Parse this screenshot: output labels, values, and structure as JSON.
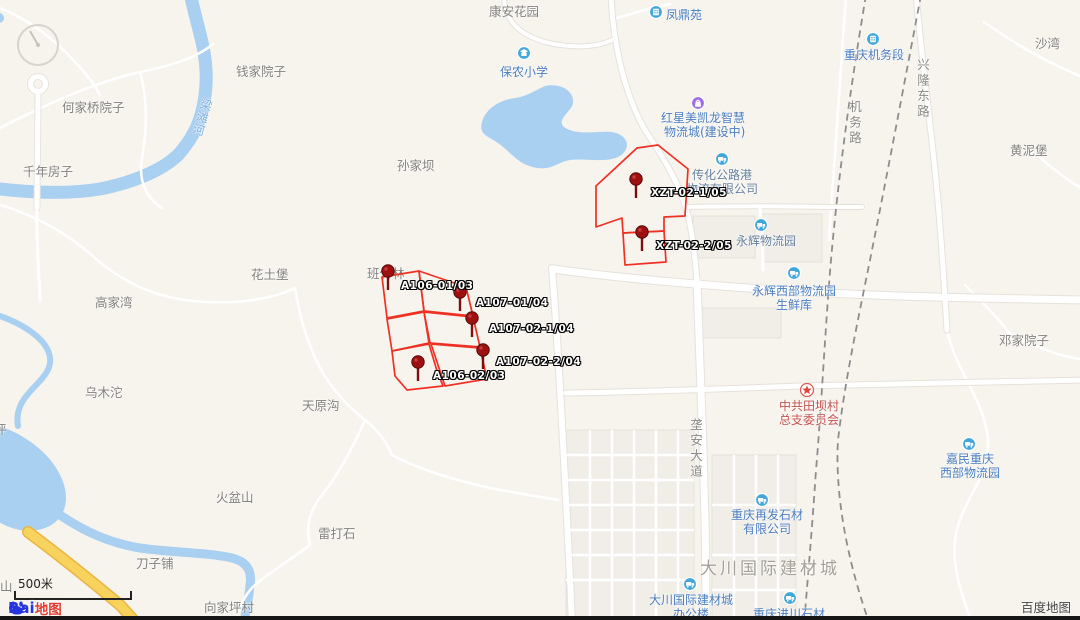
{
  "ui": {
    "scale_label": "500米",
    "attribution": "百度地图",
    "logo": {
      "bai": "Bai",
      "du": "地图"
    }
  },
  "map": {
    "colors": {
      "poi_blue": "#4a7dc0",
      "poi_grayblue": "#64819e",
      "poi_red": "#c4524e",
      "overlay_red": "#ef3124",
      "water": "#a9cff1",
      "icon_teal": "#41a7da",
      "icon_purple": "#a06ee0"
    },
    "town_labels": [
      {
        "t": "何家桥院子",
        "x": 62,
        "y": 97
      },
      {
        "t": "千年房子",
        "x": 23,
        "y": 161
      },
      {
        "t": "钱家院子",
        "x": 236,
        "y": 61
      },
      {
        "t": "孙家坝",
        "x": 397,
        "y": 155
      },
      {
        "t": "康安花园",
        "x": 489,
        "y": 1
      },
      {
        "t": "高家湾",
        "x": 95,
        "y": 292
      },
      {
        "t": "花土堡",
        "x": 251,
        "y": 264
      },
      {
        "t": "班竹林",
        "x": 367,
        "y": 263
      },
      {
        "t": "乌木沱",
        "x": 85,
        "y": 382
      },
      {
        "t": "天原沟",
        "x": 302,
        "y": 395
      },
      {
        "t": "火盆山",
        "x": 216,
        "y": 487
      },
      {
        "t": "雷打石",
        "x": 318,
        "y": 523
      },
      {
        "t": "刀子铺",
        "x": 136,
        "y": 553
      },
      {
        "t": "向家坪村",
        "x": 204,
        "y": 597
      },
      {
        "t": "沙湾",
        "x": 1035,
        "y": 33
      },
      {
        "t": "黄泥堡",
        "x": 1010,
        "y": 140
      },
      {
        "t": "邓家院子",
        "x": 999,
        "y": 330
      }
    ],
    "street_labels": [
      {
        "t": "机务路",
        "x": 845,
        "y": 100
      },
      {
        "t": "兴隆东路",
        "x": 913,
        "y": 58
      },
      {
        "t": "垄安大道",
        "x": 686,
        "y": 418
      }
    ],
    "area_label": {
      "t": "大川国际建材城",
      "x": 700,
      "y": 554
    },
    "river_label": {
      "t": "梁滩河",
      "x": 194,
      "y": 98
    },
    "partial_labels": [
      {
        "t": "坪",
        "x": -6,
        "y": 419
      },
      {
        "t": "山",
        "x": 0,
        "y": 576
      }
    ],
    "pois": [
      {
        "name": "baonong-primary-school",
        "icon": "school",
        "ix": 517,
        "iy": 46,
        "color": "#4a7dc0",
        "lines": [
          {
            "t": "保农小学",
            "x": 500,
            "y": 63
          }
        ]
      },
      {
        "name": "fengdingyuan",
        "icon": "building",
        "ix": 649,
        "iy": 5,
        "color": "#4a7dc0",
        "lines": [
          {
            "t": "凤鼎苑",
            "x": 666,
            "y": 6
          }
        ]
      },
      {
        "name": "hongxing-meikailong",
        "icon": "mall",
        "ix": 691,
        "iy": 96,
        "color": "#4a7dc0",
        "lines": [
          {
            "t": "红星美凯龙智慧",
            "x": 661,
            "y": 109
          },
          {
            "t": "物流城(建设中)",
            "x": 664,
            "y": 123
          }
        ]
      },
      {
        "name": "chuanhua-highway-port",
        "icon": "truck",
        "ix": 715,
        "iy": 152,
        "color": "#64819e",
        "lines": [
          {
            "t": "传化公路港",
            "x": 692,
            "y": 166
          },
          {
            "t": "物流有限公司",
            "x": 686,
            "y": 180
          }
        ]
      },
      {
        "name": "yonghui-logistics-park",
        "icon": "truck",
        "ix": 754,
        "iy": 218,
        "color": "#64819e",
        "lines": [
          {
            "t": "永辉物流园",
            "x": 736,
            "y": 232
          }
        ]
      },
      {
        "name": "yonghui-west-fresh",
        "icon": "truck",
        "ix": 787,
        "iy": 266,
        "color": "#4a7dc0",
        "lines": [
          {
            "t": "永辉西部物流园",
            "x": 752,
            "y": 282
          },
          {
            "t": "生鲜库",
            "x": 776,
            "y": 296
          }
        ]
      },
      {
        "name": "chongqing-locomotive-depot",
        "icon": "building",
        "ix": 866,
        "iy": 32,
        "color": "#4a7dc0",
        "lines": [
          {
            "t": "重庆机务段",
            "x": 844,
            "y": 46
          }
        ]
      },
      {
        "name": "tianba-village-committee",
        "icon": "star",
        "ix": 800,
        "iy": 383,
        "color": "#c4524e",
        "lines": [
          {
            "t": "中共田坝村",
            "x": 779,
            "y": 397
          },
          {
            "t": "总支委员会",
            "x": 779,
            "y": 411
          }
        ]
      },
      {
        "name": "goodman-west-logistics",
        "icon": "truck",
        "ix": 962,
        "iy": 437,
        "color": "#4a7dc0",
        "lines": [
          {
            "t": "嘉民重庆",
            "x": 946,
            "y": 450
          },
          {
            "t": "西部物流园",
            "x": 940,
            "y": 464
          }
        ]
      },
      {
        "name": "zaifa-stone",
        "icon": "truck",
        "ix": 755,
        "iy": 493,
        "color": "#4a7dc0",
        "lines": [
          {
            "t": "重庆再发石材",
            "x": 731,
            "y": 506
          },
          {
            "t": "有限公司",
            "x": 743,
            "y": 520
          }
        ]
      },
      {
        "name": "dachuan-office",
        "icon": "truck",
        "ix": 683,
        "iy": 577,
        "color": "#4a7dc0",
        "lines": [
          {
            "t": "大川国际建材城",
            "x": 649,
            "y": 591
          },
          {
            "t": "办公楼",
            "x": 673,
            "y": 605
          }
        ]
      },
      {
        "name": "jinchuan-stone",
        "icon": "truck",
        "ix": 783,
        "iy": 591,
        "color": "#4a7dc0",
        "lines": [
          {
            "t": "重庆进川石材",
            "x": 753,
            "y": 605
          }
        ]
      }
    ],
    "pins": [
      {
        "label": "A106-01/03",
        "x": 388,
        "y": 271,
        "lx": 401,
        "ly": 280
      },
      {
        "label": "A107-01/04",
        "x": 460,
        "y": 292,
        "lx": 476,
        "ly": 297
      },
      {
        "label": "A107-02-1/04",
        "x": 472,
        "y": 318,
        "lx": 489,
        "ly": 323
      },
      {
        "label": "A107-02-2/04",
        "x": 483,
        "y": 350,
        "lx": 496,
        "ly": 356
      },
      {
        "label": "A106-02/03",
        "x": 418,
        "y": 362,
        "lx": 433,
        "ly": 370
      },
      {
        "label": "XZT-02-1/05",
        "x": 636,
        "y": 179,
        "lx": 651,
        "ly": 187
      },
      {
        "label": "XZT-02-2/05",
        "x": 642,
        "y": 232,
        "lx": 656,
        "ly": 240
      }
    ],
    "polygons": [
      [
        [
          596,
          186
        ],
        [
          637,
          148
        ],
        [
          658,
          145
        ],
        [
          688,
          169
        ],
        [
          685,
          216
        ],
        [
          664,
          217
        ],
        [
          664,
          231
        ],
        [
          623,
          233
        ],
        [
          622,
          218
        ],
        [
          596,
          227
        ]
      ],
      [
        [
          623,
          233
        ],
        [
          664,
          231
        ],
        [
          666,
          262
        ],
        [
          625,
          265
        ]
      ],
      [
        [
          382,
          277
        ],
        [
          419,
          271
        ],
        [
          424,
          311
        ],
        [
          387,
          318
        ]
      ],
      [
        [
          419,
          271
        ],
        [
          466,
          287
        ],
        [
          473,
          316
        ],
        [
          424,
          311
        ]
      ],
      [
        [
          424,
          312
        ],
        [
          473,
          317
        ],
        [
          480,
          347
        ],
        [
          430,
          343
        ]
      ],
      [
        [
          431,
          344
        ],
        [
          480,
          348
        ],
        [
          487,
          379
        ],
        [
          445,
          386
        ]
      ],
      [
        [
          387,
          319
        ],
        [
          424,
          312
        ],
        [
          429,
          343
        ],
        [
          392,
          351
        ]
      ],
      [
        [
          392,
          351
        ],
        [
          429,
          344
        ],
        [
          437,
          371
        ],
        [
          443,
          386
        ],
        [
          407,
          390
        ],
        [
          395,
          376
        ]
      ]
    ]
  }
}
